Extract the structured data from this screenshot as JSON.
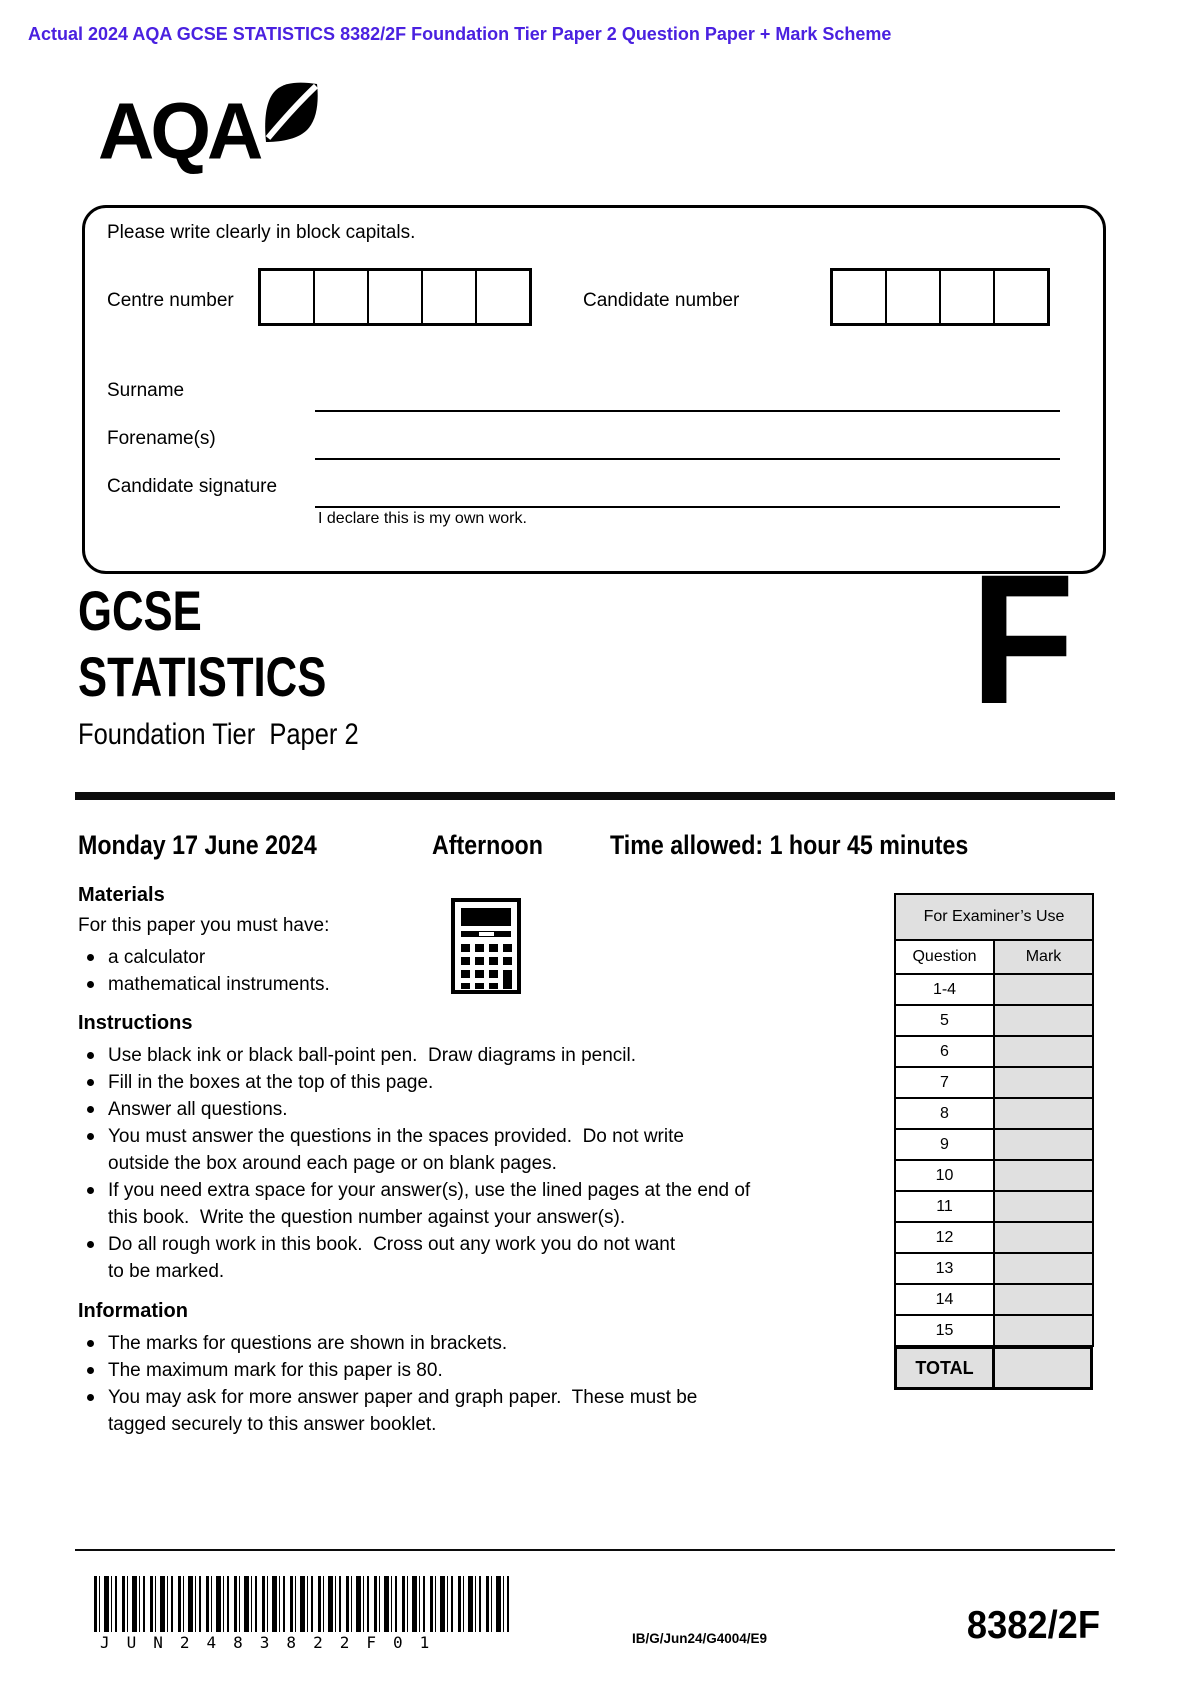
{
  "banner": {
    "text": "Actual 2024 AQA GCSE STATISTICS 8382/2F Foundation Tier Paper 2 Question Paper + Mark Scheme",
    "color": "#4a21e0"
  },
  "logo": {
    "text": "AQA"
  },
  "candidate_box": {
    "instruction": "Please write clearly in block capitals.",
    "centre_number_label": "Centre number",
    "centre_number_cells": [
      "",
      "",
      "",
      "",
      ""
    ],
    "candidate_number_label": "Candidate number",
    "candidate_number_cells": [
      "",
      "",
      "",
      ""
    ],
    "fields": [
      "Surname",
      "Forename(s)",
      "Candidate signature"
    ],
    "declaration": "I declare this is my own work."
  },
  "title": {
    "qualification": "GCSE",
    "subject": "STATISTICS",
    "tier_letter": "F",
    "tier_line": "Foundation Tier  Paper 2"
  },
  "session": {
    "date": "Monday 17 June 2024",
    "daypart": "Afternoon",
    "time_allowed": "Time allowed: 1 hour 45 minutes"
  },
  "materials": {
    "heading": "Materials",
    "intro": "For this paper you must have:",
    "items": [
      "a calculator",
      "mathematical instruments."
    ]
  },
  "instructions": {
    "heading": "Instructions",
    "items": [
      "Use black ink or black ball-point pen.  Draw diagrams in pencil.",
      "Fill in the boxes at the top of this page.",
      "Answer all questions.",
      "You must answer the questions in the spaces provided.  Do not write\noutside the box around each page or on blank pages.",
      "If you need extra space for your answer(s), use the lined pages at the end of\nthis book.  Write the question number against your answer(s).",
      "Do all rough work in this book.  Cross out any work you do not want\nto be marked."
    ]
  },
  "information": {
    "heading": "Information",
    "items": [
      "The marks for questions are shown in brackets.",
      "The maximum mark for this paper is 80.",
      "You may ask for more answer paper and graph paper.  These must be\ntagged securely to this answer booklet."
    ]
  },
  "examiner_table": {
    "title": "For Examiner’s Use",
    "col_question": "Question",
    "col_mark": "Mark",
    "rows": [
      "1-4",
      "5",
      "6",
      "7",
      "8",
      "9",
      "10",
      "11",
      "12",
      "13",
      "14",
      "15"
    ],
    "total_label": "TOTAL"
  },
  "footer": {
    "barcode_text": "JUN2483822F01",
    "ref": "IB/G/Jun24/G4004/E9",
    "paper_code": "8382/2F"
  }
}
